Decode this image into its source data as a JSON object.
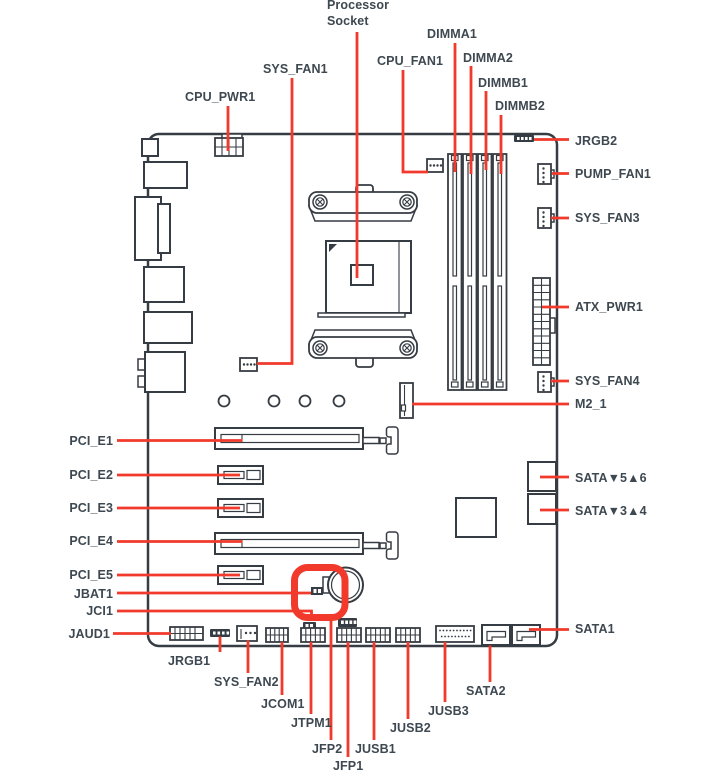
{
  "colors": {
    "red": "#f13a2b",
    "dark": "#363c43",
    "text": "#3e4851",
    "bg": "#ffffff"
  },
  "labels": {
    "processor_socket": "Processor\nSocket",
    "cpu_pwr1": "CPU_PWR1",
    "sys_fan1": "SYS_FAN1",
    "cpu_fan1": "CPU_FAN1",
    "dimma1": "DIMMA1",
    "dimma2": "DIMMA2",
    "dimmb1": "DIMMB1",
    "dimmb2": "DIMMB2",
    "jrgb2": "JRGB2",
    "pump_fan1": "PUMP_FAN1",
    "sys_fan3": "SYS_FAN3",
    "atx_pwr1": "ATX_PWR1",
    "sys_fan4": "SYS_FAN4",
    "m2_1": "M2_1",
    "sata56": "SATA▼5▲6",
    "sata34": "SATA▼3▲4",
    "sata1": "SATA1",
    "pci_e1": "PCI_E1",
    "pci_e2": "PCI_E2",
    "pci_e3": "PCI_E3",
    "pci_e4": "PCI_E4",
    "pci_e5": "PCI_E5",
    "jbat1": "JBAT1",
    "jci1": "JCI1",
    "jaud1": "JAUD1",
    "jrgb1": "JRGB1",
    "sys_fan2": "SYS_FAN2",
    "jcom1": "JCOM1",
    "jtpm1": "JTPM1",
    "jfp2": "JFP2",
    "jfp1": "JFP1",
    "jusb1": "JUSB1",
    "jusb2": "JUSB2",
    "jusb3": "JUSB3",
    "sata2": "SATA2"
  }
}
